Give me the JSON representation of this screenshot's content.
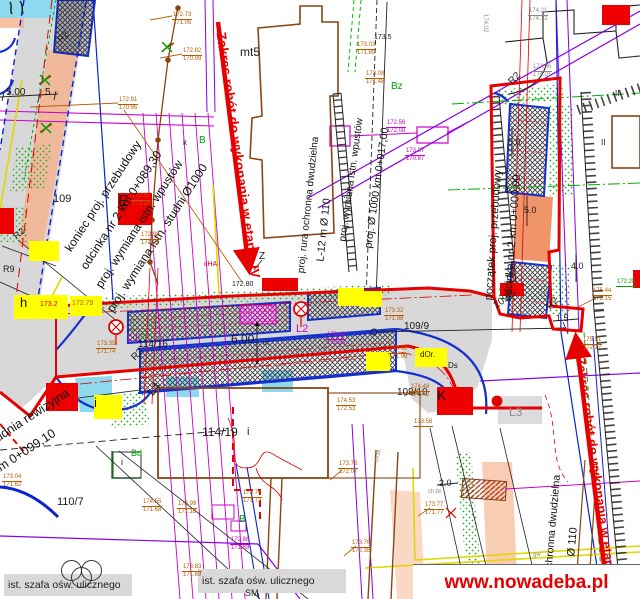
{
  "watermark": {
    "text": "www.nowadeba.pl"
  },
  "stage": {
    "left": "Zakres robót do wykonania w etapie IV",
    "right": "Zakres robót do wykonania w etapie"
  },
  "legend_bands": {
    "left": "ist. szafa ośw. ulicznego",
    "right": "ist. szafa ośw. ulicznego"
  },
  "callouts": {
    "koniec": [
      "koniec proj. przebudowy",
      "odcinka nr 2 km 0+089,30",
      "proj. wymiana istn. wpustów",
      "proj. wymiana istn. studni Ø1000"
    ],
    "studnia1": "studnia rewizyjna",
    "studnia2": "km 0+099,10",
    "rura1": "proj. rura ochronna dwudzielna",
    "l12": "L-12 m Ø 110",
    "wpusty": "proj. wymiana istn. wpustów",
    "fi1000": "proj. Ø 1000 km 0+017,00",
    "poczatek1": "początek proj. przebudowy",
    "poczatek2": "odcinka nr 2 km 0+000,00",
    "rura2": "rura ochronna dwudzielna",
    "fi110": "Ø 110"
  },
  "boxes": {
    "e": "E",
    "k": "K",
    "h": "h",
    "i": "i"
  },
  "labels": [
    {
      "t": "mt5",
      "x": 240,
      "y": 46,
      "s": 12,
      "c": "bk"
    },
    {
      "t": "173.5",
      "x": 374,
      "y": 34,
      "s": 7,
      "c": "bk"
    },
    {
      "t": "Bz",
      "x": 391,
      "y": 82,
      "s": 10,
      "c": "gn"
    },
    {
      "t": "B",
      "x": 199,
      "y": 136,
      "s": 10,
      "c": "gn"
    },
    {
      "t": "k",
      "x": 183,
      "y": 139,
      "s": 8,
      "c": "bk"
    },
    {
      "t": "109",
      "x": 53,
      "y": 194,
      "s": 11,
      "c": "bk"
    },
    {
      "t": "Z",
      "x": 259,
      "y": 252,
      "s": 10,
      "c": "bk"
    },
    {
      "t": "R2",
      "x": 56,
      "y": 38,
      "s": 9,
      "r": -45,
      "c": "bk"
    },
    {
      "t": "R2",
      "x": 12,
      "y": 234,
      "s": 9,
      "r": -40,
      "c": "bk"
    },
    {
      "t": "R9",
      "x": 3,
      "y": 265,
      "s": 9,
      "c": "bk"
    },
    {
      "t": "R2",
      "x": 507,
      "y": 80,
      "s": 10,
      "r": -45,
      "c": "bk"
    },
    {
      "t": "R2",
      "x": 545,
      "y": 305,
      "s": 10,
      "r": -45,
      "c": "bk"
    },
    {
      "t": "R2",
      "x": 130,
      "y": 356,
      "s": 10,
      "r": -45,
      "c": "bk"
    },
    {
      "t": "L4",
      "x": 145,
      "y": 390,
      "s": 12,
      "r": -50,
      "c": "bk"
    },
    {
      "t": "L1",
      "x": 127,
      "y": 333,
      "s": 11,
      "c": "mg"
    },
    {
      "t": "L2",
      "x": 296,
      "y": 324,
      "s": 11,
      "c": "mg"
    },
    {
      "t": "L3",
      "x": 509,
      "y": 406,
      "s": 12,
      "c": "gy"
    },
    {
      "t": "114/16",
      "x": 138,
      "y": 340,
      "s": 10,
      "c": "bk"
    },
    {
      "t": "114/19",
      "x": 202,
      "y": 426,
      "s": 12,
      "c": "bk"
    },
    {
      "t": "i",
      "x": 247,
      "y": 427,
      "s": 11,
      "c": "bk"
    },
    {
      "t": "110/7",
      "x": 57,
      "y": 497,
      "s": 11,
      "c": "bk"
    },
    {
      "t": "109/9",
      "x": 404,
      "y": 322,
      "s": 10,
      "c": "bk"
    },
    {
      "t": "109/10",
      "x": 397,
      "y": 388,
      "s": 10,
      "c": "bk"
    },
    {
      "t": "109/5",
      "x": 492,
      "y": 303,
      "s": 10,
      "r": -35,
      "c": "bk"
    },
    {
      "t": "6.00",
      "x": 231,
      "y": 333,
      "s": 12,
      "c": "bk"
    },
    {
      "t": "m",
      "x": 263,
      "y": 340,
      "s": 7,
      "c": "bk"
    },
    {
      "t": "5.00",
      "x": 6,
      "y": 88,
      "s": 10,
      "c": "bk"
    },
    {
      "t": "5",
      "x": 45,
      "y": 88,
      "s": 10,
      "c": "bk"
    },
    {
      "t": "5.0",
      "x": 508,
      "y": 138,
      "s": 9,
      "c": "bk"
    },
    {
      "t": "5.0",
      "x": 524,
      "y": 206,
      "s": 9,
      "c": "bk"
    },
    {
      "t": "4.0",
      "x": 571,
      "y": 262,
      "s": 9,
      "c": "bk"
    },
    {
      "t": "2.0",
      "x": 439,
      "y": 479,
      "s": 9,
      "c": "bk"
    },
    {
      "t": "1.5",
      "x": 556,
      "y": 314,
      "s": 9,
      "c": "bk"
    },
    {
      "t": "II",
      "x": 615,
      "y": 90,
      "s": 8,
      "c": "bk"
    },
    {
      "t": "II",
      "x": 601,
      "y": 139,
      "s": 8,
      "c": "bk"
    },
    {
      "t": "Bd",
      "x": 131,
      "y": 449,
      "s": 9,
      "c": "gn"
    },
    {
      "t": "B",
      "x": 239,
      "y": 515,
      "s": 10,
      "c": "gn"
    },
    {
      "t": "i",
      "x": 121,
      "y": 458,
      "s": 9,
      "c": "bk"
    },
    {
      "t": "cHA",
      "x": 204,
      "y": 261,
      "s": 7,
      "c": "rd"
    },
    {
      "t": "ch.bł.",
      "x": 428,
      "y": 489,
      "s": 6,
      "c": "gy"
    },
    {
      "t": "ch.bł.",
      "x": 374,
      "y": 462,
      "s": 6,
      "r": -78,
      "c": "gy"
    },
    {
      "t": "gw",
      "x": 533,
      "y": 552,
      "s": 6,
      "c": "gy"
    },
    {
      "t": "SM",
      "x": 245,
      "y": 589,
      "s": 9,
      "c": "bk"
    },
    {
      "t": "dOr.",
      "x": 420,
      "y": 351,
      "s": 8,
      "c": "bk"
    },
    {
      "t": "Ds",
      "x": 448,
      "y": 362,
      "s": 8,
      "c": "bk"
    },
    {
      "t": "172.80",
      "x": 232,
      "y": 281,
      "s": 7,
      "c": "bk"
    },
    {
      "t": "173.2",
      "x": 40,
      "y": 301,
      "s": 7,
      "c": "rd"
    },
    {
      "t": "172.79",
      "x": 72,
      "y": 300,
      "s": 7,
      "c": "or"
    },
    {
      "t": "174.02",
      "x": 488,
      "y": 14,
      "s": 6,
      "r": 90,
      "c": "gy"
    }
  ],
  "elevations": [
    {
      "x": 172,
      "y": 12,
      "a": "172.73",
      "b": "171.05",
      "c": "or"
    },
    {
      "x": 182,
      "y": 48,
      "a": "172.82",
      "b": "170.99",
      "c": "or"
    },
    {
      "x": 356,
      "y": 42,
      "a": "173.03",
      "b": "171.89",
      "c": "or"
    },
    {
      "x": 365,
      "y": 71,
      "a": "173.08",
      "b": "171.48",
      "c": "or"
    },
    {
      "x": 118,
      "y": 97,
      "a": "172.91",
      "b": "170.95",
      "c": "or"
    },
    {
      "x": 386,
      "y": 120,
      "a": "172.56",
      "b": "172.08",
      "c": "mg"
    },
    {
      "x": 405,
      "y": 148,
      "a": "173.37",
      "b": "170.87",
      "c": "mg"
    },
    {
      "x": 528,
      "y": 8,
      "a": "174.21",
      "b": "174.13",
      "c": "gy"
    },
    {
      "x": 532,
      "y": 64,
      "a": "174.06",
      "b": "174.01",
      "c": "gy"
    },
    {
      "x": 131,
      "y": 193,
      "a": "172.97",
      "b": "171.10",
      "c": "or"
    },
    {
      "x": 140,
      "y": 232,
      "a": "172.98",
      "b": "171.22",
      "c": "or"
    },
    {
      "x": 384,
      "y": 308,
      "a": "173.32",
      "b": "171.98",
      "c": "or"
    },
    {
      "x": 388,
      "y": 346,
      "a": "173.30",
      "b": "171.99",
      "c": "or"
    },
    {
      "x": 96,
      "y": 341,
      "a": "173.35",
      "b": "171.74",
      "c": "or"
    },
    {
      "x": 326,
      "y": 332,
      "a": "173.42",
      "b": "172.03",
      "c": "mg"
    },
    {
      "x": 2,
      "y": 474,
      "a": "173.04",
      "b": "171.62",
      "c": "or"
    },
    {
      "x": 142,
      "y": 499,
      "a": "174.55",
      "b": "171.68",
      "c": "or"
    },
    {
      "x": 177,
      "y": 501,
      "a": "173.99",
      "b": "171.18",
      "c": "or"
    },
    {
      "x": 242,
      "y": 490,
      "a": "173.74",
      "b": "171.72",
      "c": "or"
    },
    {
      "x": 230,
      "y": 537,
      "a": "172.86",
      "b": "171.69",
      "c": "mg"
    },
    {
      "x": 182,
      "y": 564,
      "a": "173.83",
      "b": "171.69",
      "c": "or"
    },
    {
      "x": 338,
      "y": 461,
      "a": "173.76",
      "b": "172.07",
      "c": "or"
    },
    {
      "x": 351,
      "y": 540,
      "a": "173.76",
      "b": "172.38",
      "c": "or"
    },
    {
      "x": 336,
      "y": 398,
      "a": "174.53",
      "b": "172.53",
      "c": "or"
    },
    {
      "x": 424,
      "y": 502,
      "a": "173.77",
      "b": "171.77",
      "c": "or"
    },
    {
      "x": 431,
      "y": 572,
      "a": "173.82",
      "b": "172.59",
      "c": "or"
    },
    {
      "x": 582,
      "y": 337,
      "a": "175.51",
      "b": "172.17",
      "c": "or"
    },
    {
      "x": 592,
      "y": 288,
      "a": "175.44",
      "b": "172.15",
      "c": "or"
    },
    {
      "x": 616,
      "y": 279,
      "a": "172.28",
      "b": "",
      "c": "gn"
    },
    {
      "x": 410,
      "y": 384,
      "a": "174.48",
      "b": "171.42",
      "c": "or"
    },
    {
      "x": 413,
      "y": 419,
      "a": "173.56",
      "b": "",
      "c": "or"
    }
  ]
}
